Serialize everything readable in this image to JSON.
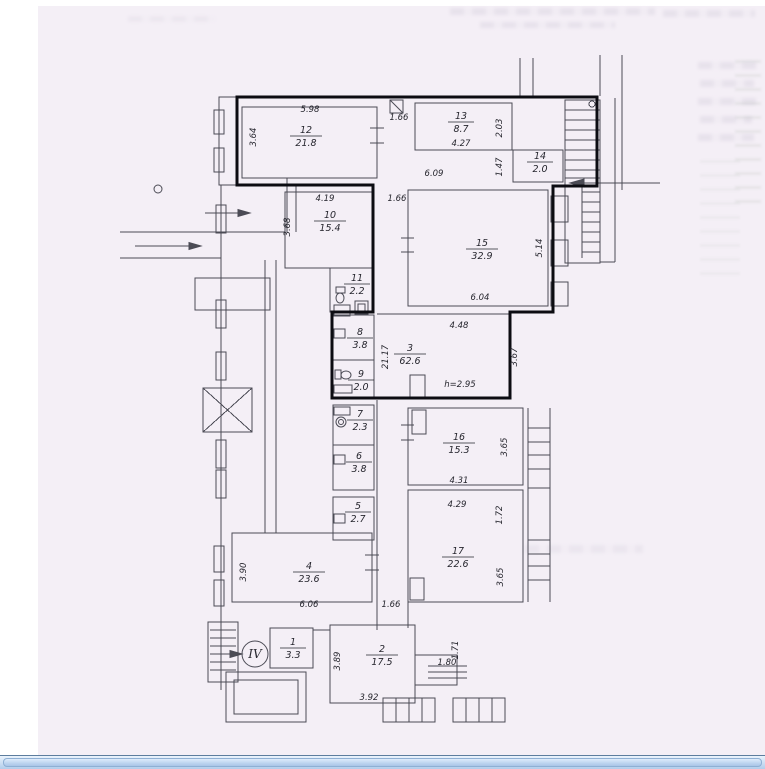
{
  "palette": {
    "page_bg": "#f4eff6",
    "margin_bg": "#ffffff",
    "wall_ink": "#4b4b55",
    "boundary_ink": "#0c0c12",
    "label_ink": "#26262e",
    "scrollbar_border": "#5d7d9e",
    "scrollbar_track_top": "#eaf3fd",
    "scrollbar_track_bottom": "#b2cdeb"
  },
  "plan": {
    "section_label": "IV",
    "height_note": "h=2.95",
    "rooms": [
      {
        "num": "12",
        "area": "21.8",
        "x": 306,
        "y": 136
      },
      {
        "num": "13",
        "area": "8.7",
        "x": 461,
        "y": 122
      },
      {
        "num": "14",
        "area": "2.0",
        "x": 540,
        "y": 162
      },
      {
        "num": "10",
        "area": "15.4",
        "x": 330,
        "y": 221
      },
      {
        "num": "15",
        "area": "32.9",
        "x": 482,
        "y": 249
      },
      {
        "num": "11",
        "area": "2.2",
        "x": 357,
        "y": 284
      },
      {
        "num": "8",
        "area": "3.8",
        "x": 360,
        "y": 338
      },
      {
        "num": "3",
        "area": "62.6",
        "x": 410,
        "y": 354
      },
      {
        "num": "9",
        "area": "2.0",
        "x": 361,
        "y": 380
      },
      {
        "num": "7",
        "area": "2.3",
        "x": 360,
        "y": 420
      },
      {
        "num": "6",
        "area": "3.8",
        "x": 359,
        "y": 462
      },
      {
        "num": "5",
        "area": "2.7",
        "x": 358,
        "y": 512
      },
      {
        "num": "16",
        "area": "15.3",
        "x": 459,
        "y": 443
      },
      {
        "num": "17",
        "area": "22.6",
        "x": 458,
        "y": 557
      },
      {
        "num": "4",
        "area": "23.6",
        "x": 309,
        "y": 572
      },
      {
        "num": "1",
        "area": "3.3",
        "x": 293,
        "y": 648
      },
      {
        "num": "2",
        "area": "17.5",
        "x": 382,
        "y": 655
      }
    ],
    "dims": [
      {
        "text": "5.98",
        "x": 310,
        "y": 112,
        "vertical": false
      },
      {
        "text": "3.64",
        "x": 256,
        "y": 137,
        "vertical": true
      },
      {
        "text": "1.66",
        "x": 399,
        "y": 120,
        "vertical": false
      },
      {
        "text": "4.27",
        "x": 461,
        "y": 146,
        "vertical": false
      },
      {
        "text": "2.03",
        "x": 502,
        "y": 128,
        "vertical": true
      },
      {
        "text": "1.47",
        "x": 502,
        "y": 167,
        "vertical": true
      },
      {
        "text": "6.09",
        "x": 434,
        "y": 176,
        "vertical": false
      },
      {
        "text": "4.19",
        "x": 325,
        "y": 201,
        "vertical": false
      },
      {
        "text": "1.66",
        "x": 397,
        "y": 201,
        "vertical": false
      },
      {
        "text": "3.68",
        "x": 290,
        "y": 227,
        "vertical": true
      },
      {
        "text": "5.14",
        "x": 542,
        "y": 248,
        "vertical": true
      },
      {
        "text": "6.04",
        "x": 480,
        "y": 300,
        "vertical": false
      },
      {
        "text": "4.48",
        "x": 459,
        "y": 328,
        "vertical": false
      },
      {
        "text": "21.17",
        "x": 388,
        "y": 357,
        "vertical": true
      },
      {
        "text": "3.67",
        "x": 517,
        "y": 357,
        "vertical": true
      },
      {
        "text": "h=2.95",
        "x": 460,
        "y": 387,
        "vertical": false
      },
      {
        "text": "3.65",
        "x": 507,
        "y": 447,
        "vertical": true
      },
      {
        "text": "4.31",
        "x": 459,
        "y": 483,
        "vertical": false
      },
      {
        "text": "4.29",
        "x": 457,
        "y": 507,
        "vertical": false
      },
      {
        "text": "1.72",
        "x": 502,
        "y": 515,
        "vertical": true
      },
      {
        "text": "3.90",
        "x": 246,
        "y": 572,
        "vertical": true
      },
      {
        "text": "3.65",
        "x": 503,
        "y": 577,
        "vertical": true
      },
      {
        "text": "6.06",
        "x": 309,
        "y": 607,
        "vertical": false
      },
      {
        "text": "1.66",
        "x": 391,
        "y": 607,
        "vertical": false
      },
      {
        "text": "3.89",
        "x": 340,
        "y": 661,
        "vertical": true
      },
      {
        "text": "1.80",
        "x": 447,
        "y": 665,
        "vertical": false
      },
      {
        "text": "1.71",
        "x": 458,
        "y": 650,
        "vertical": true
      },
      {
        "text": "3.92",
        "x": 369,
        "y": 700,
        "vertical": false
      }
    ]
  },
  "scrollbar": {
    "orientation": "horizontal"
  }
}
